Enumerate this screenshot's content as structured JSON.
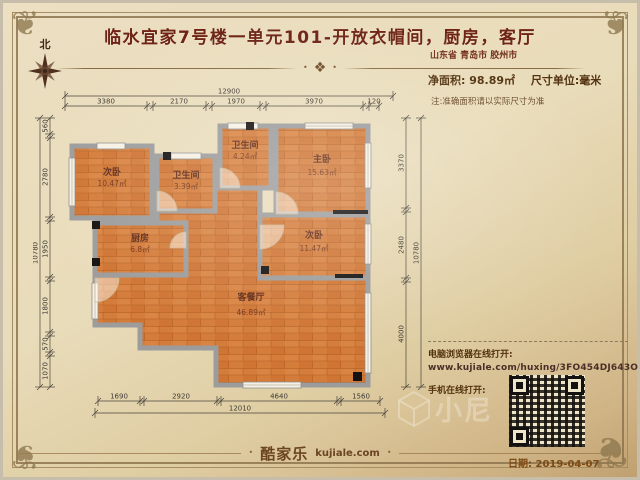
{
  "header": {
    "title": "临水宜家7号楼一单元101-开放衣帽间，厨房，客厅",
    "location": "山东省 青岛市 胶州市"
  },
  "info": {
    "net_area_label": "净面积:",
    "net_area_value": "98.89㎡",
    "unit_label": "尺寸单位:毫米",
    "note": "注:准确面积请以实际尺寸为准"
  },
  "compass": {
    "north_label": "北"
  },
  "plan": {
    "rooms": [
      {
        "name": "次卧",
        "area": "10.47㎡"
      },
      {
        "name": "卫生间",
        "area": "3.39㎡"
      },
      {
        "name": "卫生间",
        "area": "4.24㎡"
      },
      {
        "name": "主卧",
        "area": "15.63㎡"
      },
      {
        "name": "厨房",
        "area": "6.8㎡"
      },
      {
        "name": "次卧",
        "area": "11.47㎡"
      },
      {
        "name": "客餐厅",
        "area": "46.89㎡"
      }
    ],
    "dims": {
      "top_total": "12900",
      "top_segments": [
        "3380",
        "2170",
        "1970",
        "3970",
        "120"
      ],
      "left_total": "10780",
      "left_segments": [
        "560",
        "2780",
        "1950",
        "1800",
        "570",
        "1070"
      ],
      "right_total": "10780",
      "right_segments": [
        "3370",
        "2480",
        "4000"
      ],
      "bottom_total": "12010",
      "bottom_segments": [
        "1690",
        "2920",
        "4640",
        "1560"
      ]
    }
  },
  "links": {
    "pc_label": "电脑浏览器在线打开:",
    "url": "www.kujiale.com/huxing/3FO454DJ643O",
    "mobile_label": "手机在线打开:"
  },
  "footer": {
    "brand": "酷家乐",
    "brand_domain": "kujiale.com",
    "date": "日期: 2019-04-07"
  },
  "watermark": {
    "text": "小尼"
  },
  "colors": {
    "title_text": "#6e2314",
    "floor_wood": "#d47c3a",
    "wall_gray": "#9c9c9c",
    "parchment": "#e9dcba"
  }
}
